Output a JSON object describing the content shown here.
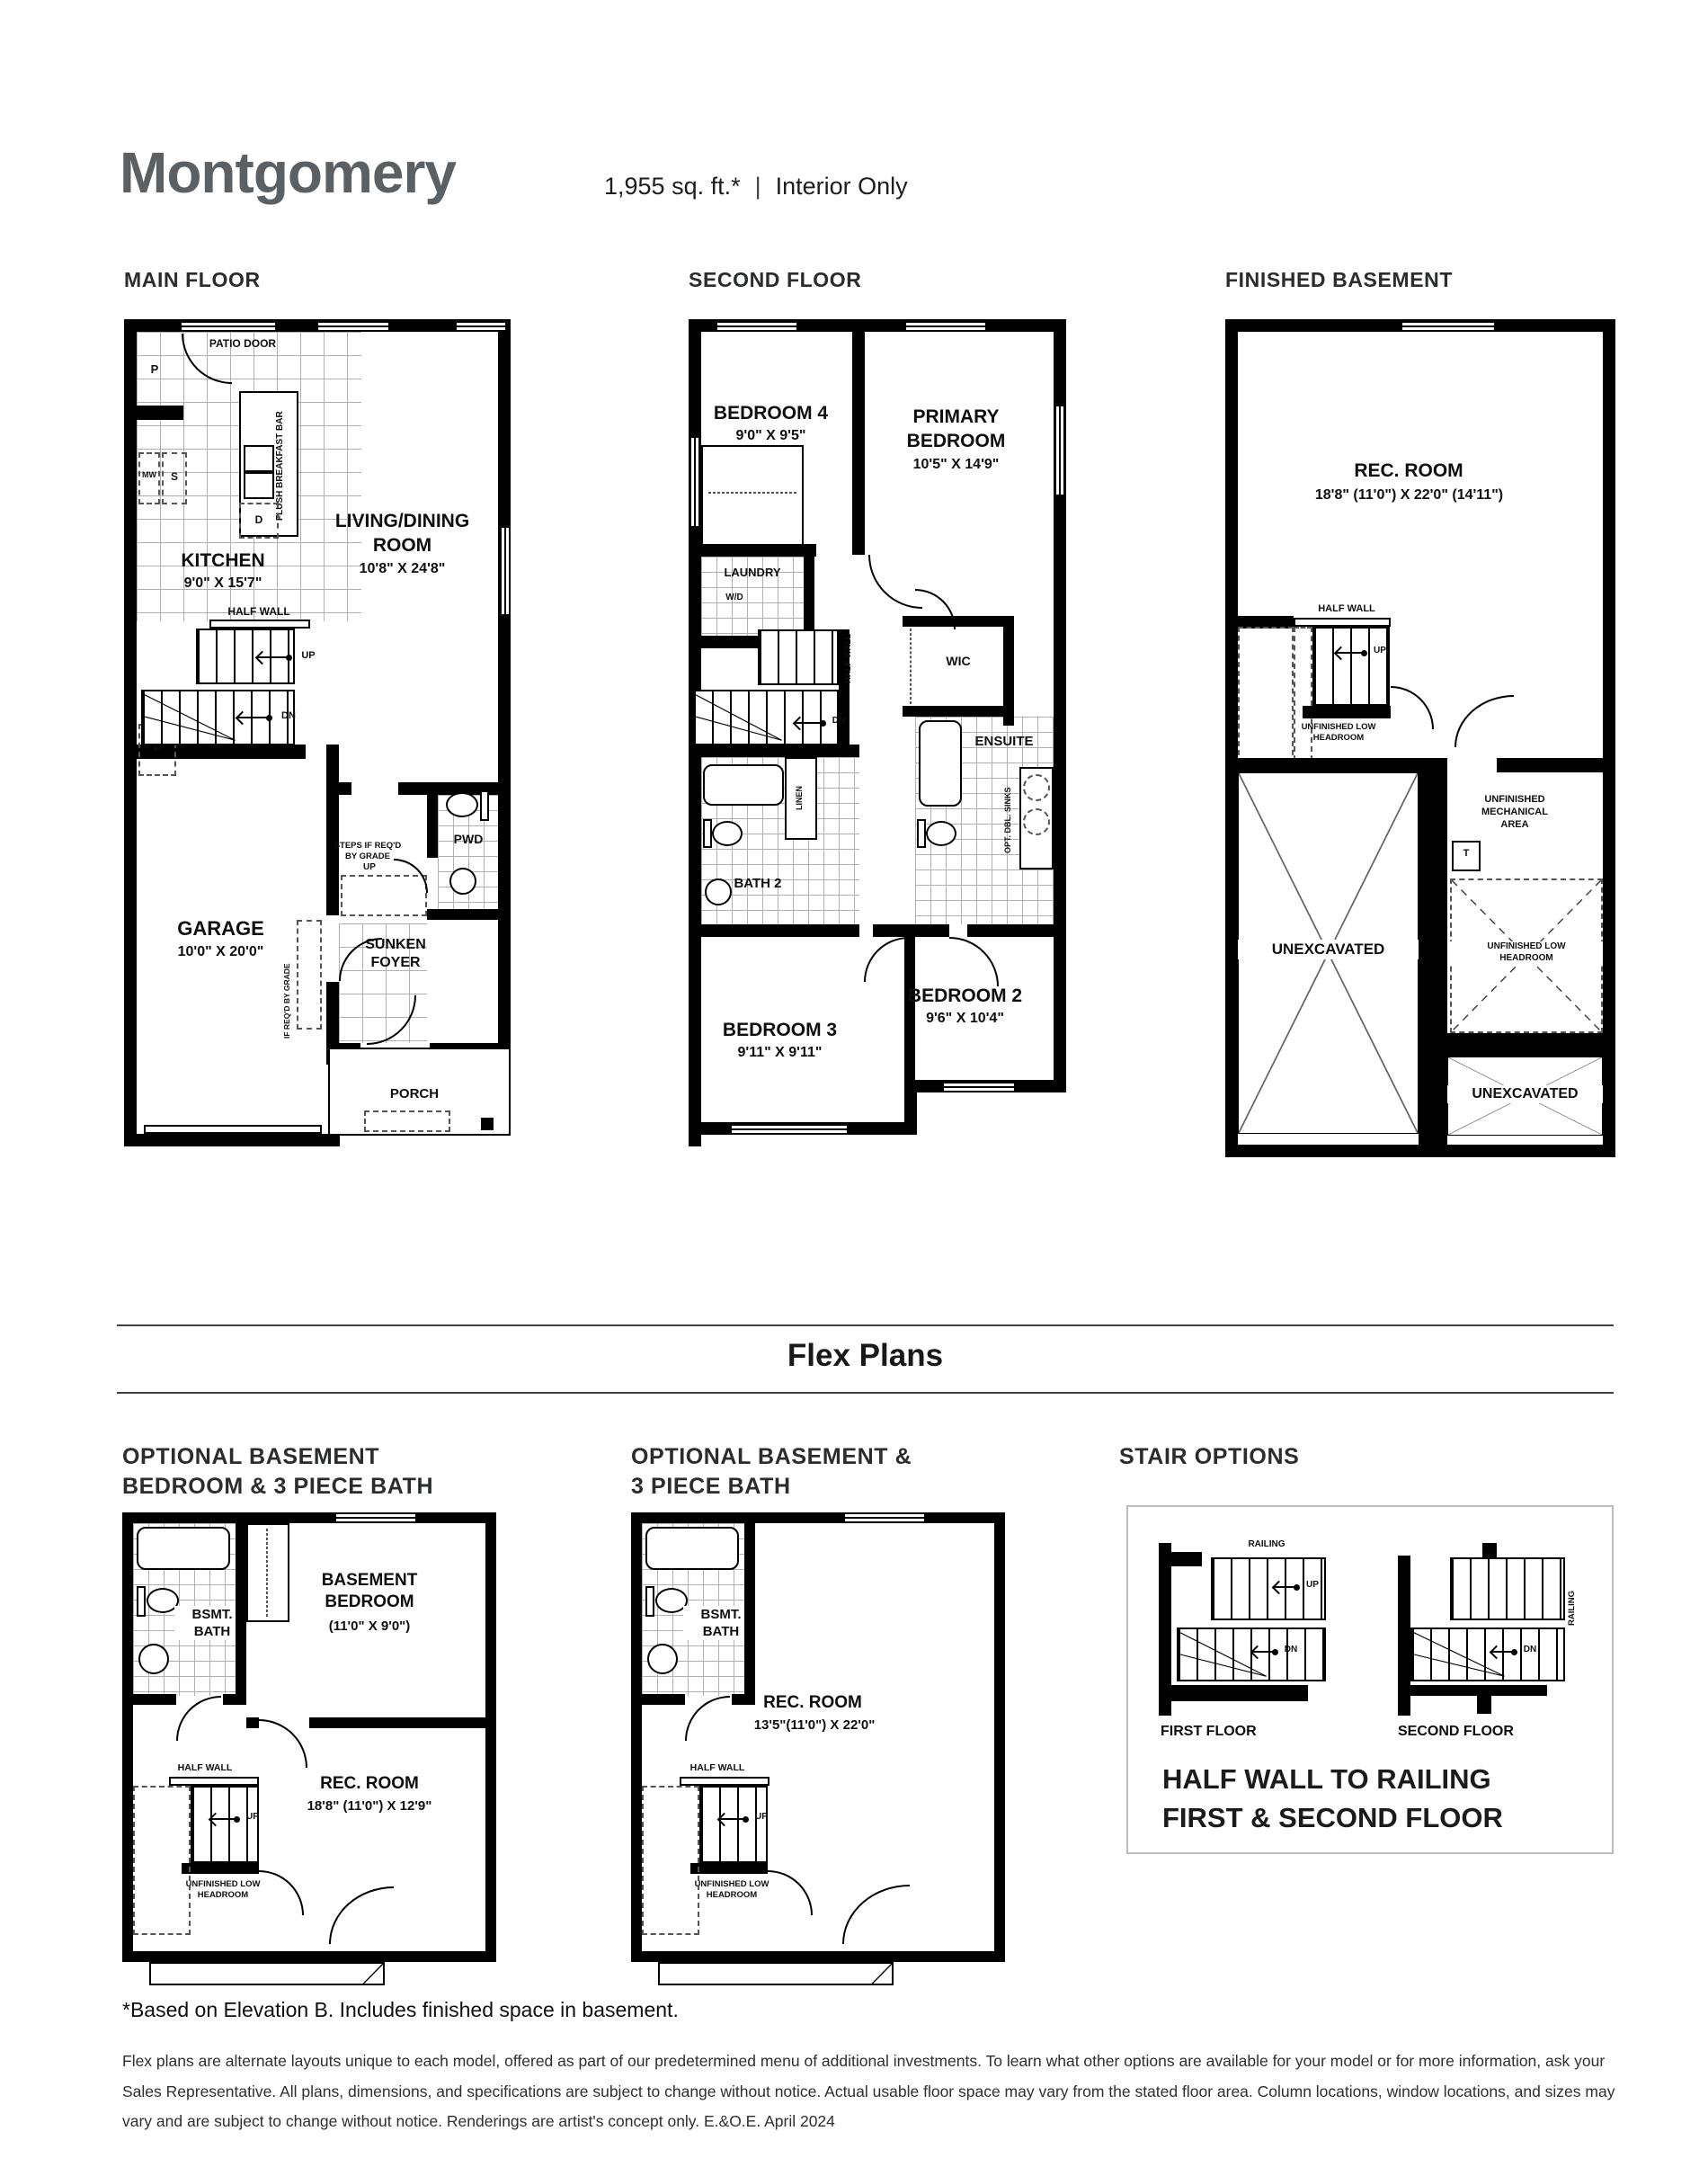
{
  "header": {
    "title": "Montgomery",
    "sqft": "1,955 sq. ft.*",
    "divider": "|",
    "type": "Interior Only"
  },
  "main_floor": {
    "label": "MAIN FLOOR",
    "patio_door": "PATIO DOOR",
    "pantry": "P",
    "mw": "MW",
    "sink": "S",
    "dw": "D",
    "fridge": "F",
    "breakfast_bar": "FLUSH BREAKFAST BAR",
    "kitchen_name": "KITCHEN",
    "kitchen_dims": "9'0\" X 15'7\"",
    "living_name": "LIVING/DINING\nROOM",
    "living_dims": "10'8\" X 24'8\"",
    "half_wall": "HALF WALL",
    "up": "UP",
    "dn": "DN",
    "garage_name": "GARAGE",
    "garage_dims": "10'0\" X 20'0\"",
    "steps_note": "STEPS IF REQ'D\nBY GRADE",
    "steps_up": "UP",
    "pwd": "PWD",
    "foyer": "SUNKEN\nFOYER",
    "grade_note": "IF REQ'D BY GRADE",
    "porch": "PORCH"
  },
  "second_floor": {
    "label": "SECOND FLOOR",
    "bedroom4_name": "BEDROOM 4",
    "bedroom4_dims": "9'0\" X 9'5\"",
    "primary_name": "PRIMARY\nBEDROOM",
    "primary_dims": "10'5\" X 14'9\"",
    "laundry": "LAUNDRY",
    "wd": "W/D",
    "half_wall": "HALF WALL",
    "dn": "DN",
    "wic": "WIC",
    "ensuite": "ENSUITE",
    "opt_dbl_sinks": "OPT. DBL. SINKS",
    "linen": "LINEN",
    "bath2": "BATH 2",
    "bedroom3_name": "BEDROOM 3",
    "bedroom3_dims": "9'11\" X 9'11\"",
    "bedroom2_name": "BEDROOM 2",
    "bedroom2_dims": "9'6\" X 10'4\""
  },
  "basement": {
    "label": "FINISHED BASEMENT",
    "rec_name": "REC. ROOM",
    "rec_dims": "18'8\" (11'0\") X 22'0\" (14'11\")",
    "half_wall": "HALF WALL",
    "up": "UP",
    "low_headroom": "UNFINISHED LOW\nHEADROOM",
    "unexcavated_left": "UNEXCAVATED",
    "mechanical": "UNFINISHED\nMECHANICAL\nAREA",
    "tank": "T",
    "low_headroom2": "UNFINISHED LOW\nHEADROOM",
    "unexcavated_right": "UNEXCAVATED"
  },
  "flex": {
    "title": "Flex Plans",
    "left": {
      "header": "OPTIONAL BASEMENT\nBEDROOM & 3 PIECE BATH",
      "bath": "BSMT.\nBATH",
      "bedroom_name": "BASEMENT\nBEDROOM",
      "bedroom_dims": "(11'0\" X 9'0\")",
      "half_wall": "HALF WALL",
      "up": "UP",
      "rec_name": "REC. ROOM",
      "rec_dims": "18'8\" (11'0\") X 12'9\"",
      "low_headroom": "UNFINISHED LOW\nHEADROOM"
    },
    "middle": {
      "header": "OPTIONAL BASEMENT &\n3 PIECE BATH",
      "bath": "BSMT.\nBATH",
      "rec_name": "REC. ROOM",
      "rec_dims": "13'5\"(11'0\") X 22'0\"",
      "half_wall": "HALF WALL",
      "up": "UP",
      "low_headroom": "UNFINISHED LOW\nHEADROOM"
    },
    "stairs": {
      "header": "STAIR OPTIONS",
      "railing": "RAILING",
      "up": "UP",
      "dn": "DN",
      "first": "FIRST FLOOR",
      "second": "SECOND FLOOR",
      "caption": "HALF WALL TO RAILING\nFIRST & SECOND FLOOR"
    }
  },
  "footer": {
    "note": "*Based on Elevation B. Includes finished space in basement.",
    "disclaimer": "Flex plans are alternate layouts unique to each model, offered as part of our predetermined menu of additional investments. To learn what other options are available for your model or for more information, ask your Sales Representative. All plans, dimensions, and specifications are subject to change without notice. Actual usable floor space may vary from the stated floor area. Column locations, window locations, and sizes may vary and are subject to change without notice. Renderings are artist's concept only. E.&O.E. April 2024"
  },
  "colors": {
    "title": "#5b6064",
    "text": "#1d1d1f",
    "wall": "#000000",
    "grid": "#b0b0b0"
  }
}
